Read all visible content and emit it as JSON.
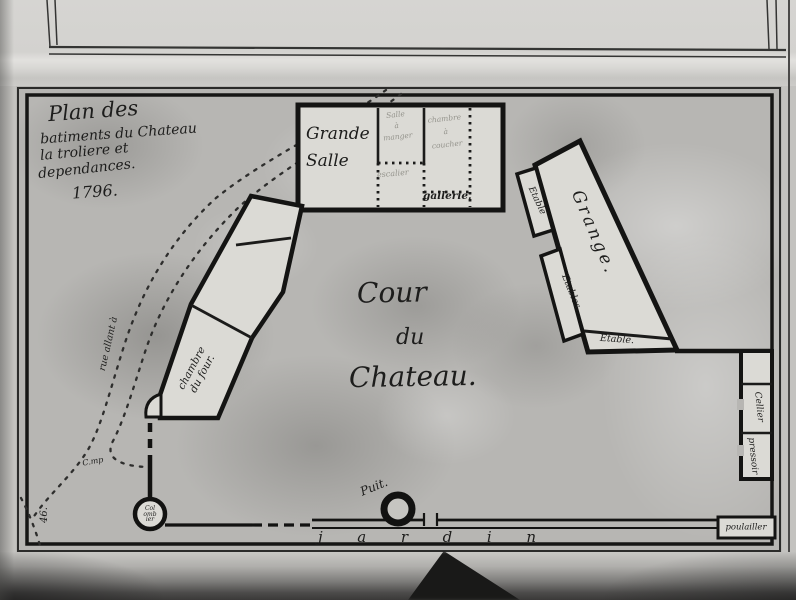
{
  "title_block": {
    "line1": "Plan des",
    "line2": "batiments du Chateau",
    "line3": "la troliere et",
    "line4": "dependances.",
    "line5": "1796."
  },
  "courtyard": {
    "line1": "Cour",
    "line2": "du",
    "line3": "Chateau."
  },
  "buildings": {
    "grande_salle": {
      "line1": "Grande",
      "line2": "Salle"
    },
    "salle_a_manger": {
      "line1": "Salle",
      "line2": "à",
      "line3": "manger"
    },
    "chambre_a_coucher": {
      "line1": "chambre",
      "line2": "à",
      "line3": "coucher"
    },
    "escalier": {
      "label": "escalier"
    },
    "gallerie": {
      "label": "gallerie."
    },
    "chambre_du_four": {
      "line1": "chambre",
      "line2": "du four."
    },
    "grange": {
      "label": "Grange."
    },
    "etable_top": {
      "label": "Etable"
    },
    "etables_mid": {
      "label": "Etables."
    },
    "etable_bottom": {
      "label": "Etable."
    },
    "cellier": {
      "label": "Cellier"
    },
    "pressoir": {
      "label": "pressoir"
    },
    "poulailler": {
      "label": "poulailler"
    },
    "colombier": {
      "line1": "Col",
      "line2": "omb",
      "line3": "ier"
    }
  },
  "features": {
    "puit_label": "Puit.",
    "jardin_letters": [
      "j",
      "a",
      "r",
      "d",
      "i",
      "n"
    ],
    "road_label": "rue allant à",
    "road_label_2": "C.mp",
    "plate_number": "46."
  },
  "colors": {
    "ink": "#1d1d1c",
    "paper": "#b7b6b3",
    "building_fill": "#dbdad5",
    "pencil": "#94938c"
  }
}
